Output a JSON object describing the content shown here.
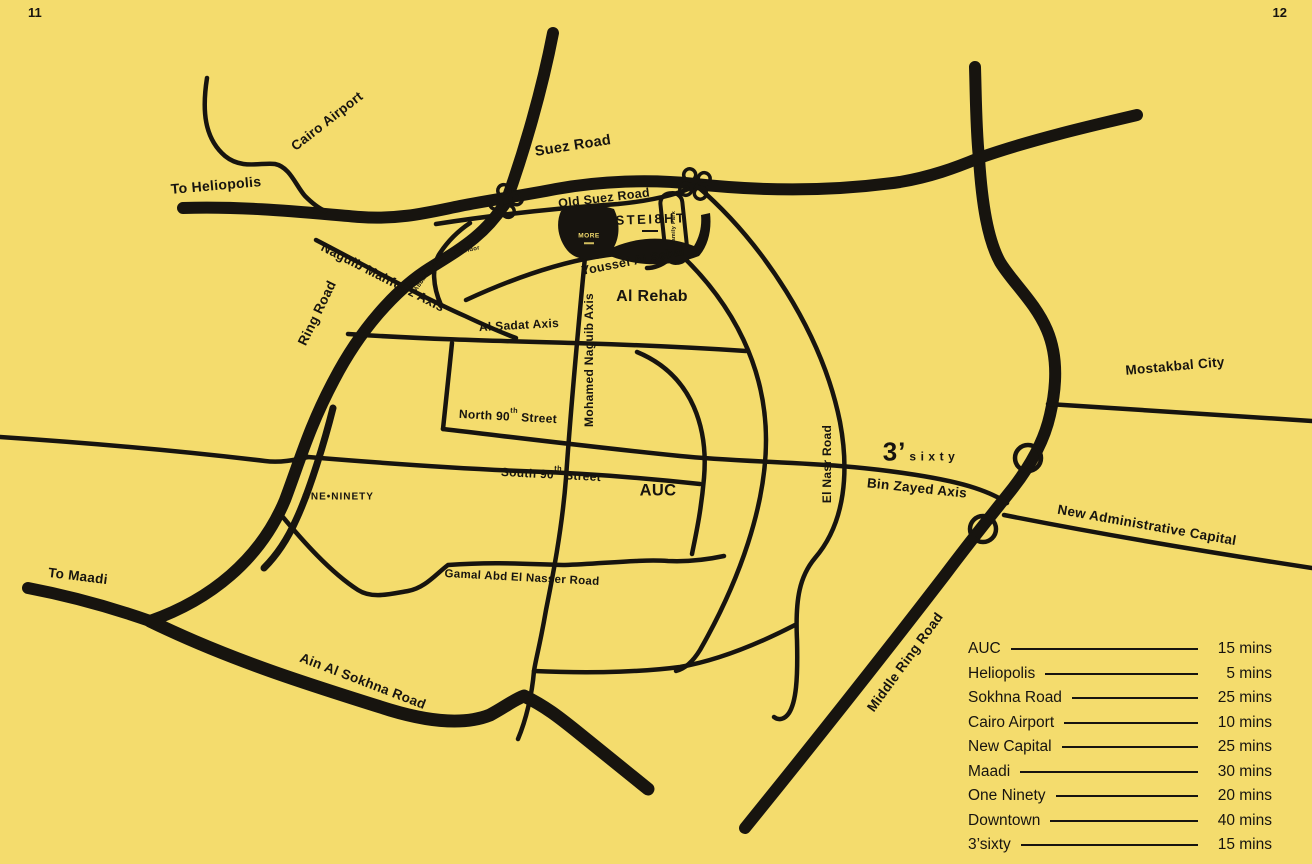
{
  "page": {
    "left_page_number": "11",
    "right_page_number": "12"
  },
  "colors": {
    "background": "#F4DC6D",
    "road": "#17140F"
  },
  "map": {
    "labels": {
      "cairo_airport": "Cairo Airport",
      "to_heliopolis": "To Heliopolis",
      "suez_road": "Suez Road",
      "old_suez_road": "Old Suez Road",
      "family_park": "Family Park",
      "naguib_mahfouz_axis": "Naguib Mahfouz Axis",
      "ring_road": "Ring Road",
      "abbas_al_akad": "Abbas Al Akad",
      "corridor": "Corridor",
      "youssef_al_sebai": "Youssef Al Sebai",
      "al_rehab": "Al Rehab",
      "al_sadat_axis": "Al Sadat Axis",
      "mohamed_naguib_axis": "Mohamed Naguib Axis",
      "north_90": {
        "pre": "North 90",
        "sup": "th",
        "post": " Street"
      },
      "south_90": {
        "pre": "South 90",
        "sup": "th",
        "post": " Street"
      },
      "one_ninety": "ONE•NINETY",
      "auc": "AUC",
      "el_nasr_road": "El Nasr Road",
      "bin_zayed_axis": "Bin Zayed Axis",
      "mostakbal_city": "Mostakbal City",
      "new_admin_capital": "New Administrative Capital",
      "middle_ring_road": "Middle Ring Road",
      "gamal_abd_el_nasser": "Gamal Abd El Nasser Road",
      "to_maadi": "To Maadi",
      "ain_al_sokhna_road": "Ain Al Sokhna Road"
    },
    "logos": {
      "steight": "STEI8HT",
      "more": "MORE",
      "three_sixty_prefix": "3’",
      "three_sixty_word": "sixty"
    }
  },
  "legend": {
    "rows": [
      {
        "label": "AUC",
        "time": "15 mins"
      },
      {
        "label": "Heliopolis",
        "time": "5 mins"
      },
      {
        "label": "Sokhna Road",
        "time": "25 mins"
      },
      {
        "label": "Cairo Airport",
        "time": "10 mins"
      },
      {
        "label": "New Capital",
        "time": "25 mins"
      },
      {
        "label": "Maadi",
        "time": "30 mins"
      },
      {
        "label": "One Ninety",
        "time": "20 mins"
      },
      {
        "label": "Downtown",
        "time": "40 mins"
      },
      {
        "label": "3’sixty",
        "time": "15 mins"
      }
    ]
  }
}
